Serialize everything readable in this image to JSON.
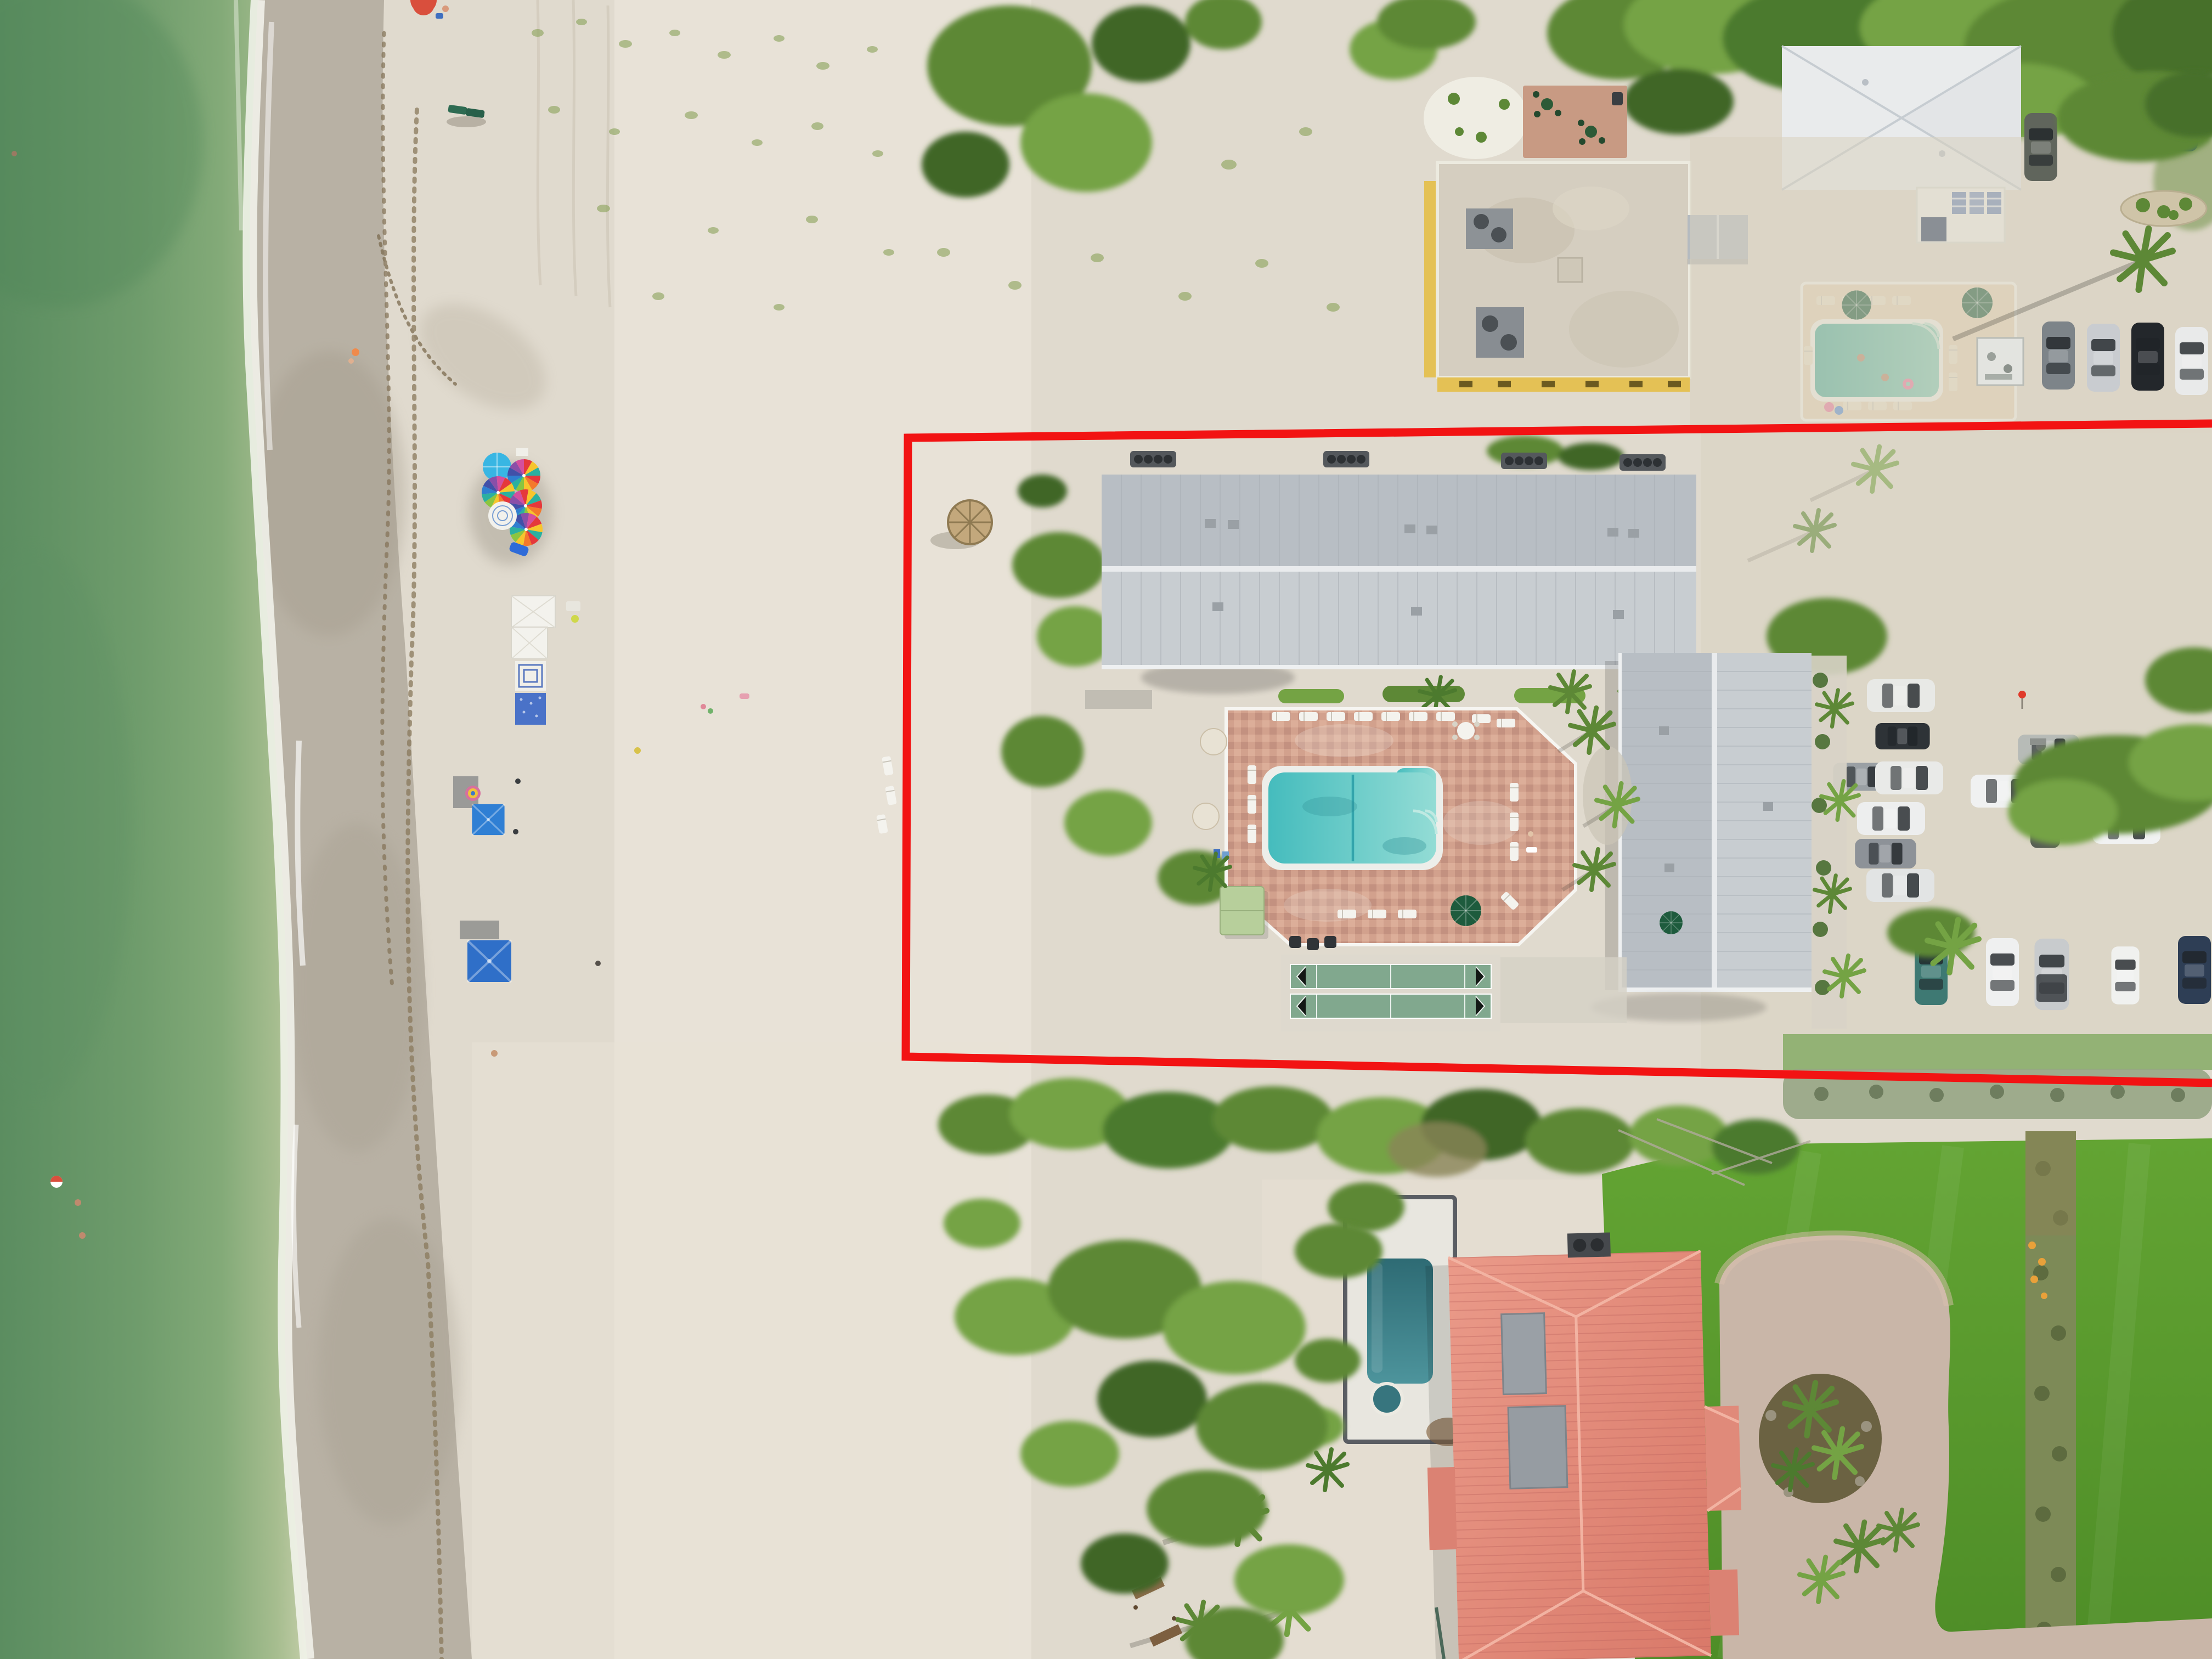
{
  "scene": {
    "title": "Top-down aerial drone photo of a beachfront resort parcel outlined in red",
    "type": "aerial-photograph",
    "view": "nadir (straight down)",
    "setting": "white-sand gulf beach, dune vegetation, condo buildings, pools, shell parking lot, neighboring estate with coral tile roof"
  },
  "palette": {
    "ocean_deep": "#5b8d60",
    "ocean": "#6f9c6c",
    "ocean_mid": "#83aa78",
    "ocean_shallow": "#a6bd8f",
    "ocean_pale": "#c3cda8",
    "foam": "#f4f6ee",
    "wet_sand": "#b8b1a4",
    "wet_sand_dark": "#a09888",
    "damp_sand": "#cfc8ba",
    "sand": "#e0dace",
    "sand_bright": "#eee9df",
    "wrack_brown": "#86755a",
    "veg_dark": "#3f6628",
    "veg": "#5d8836",
    "veg_bright": "#74a344",
    "veg_olive": "#7e8a4e",
    "veg_gray": "#97a585",
    "veg_brown": "#8a8456",
    "grass_light": "#63a433",
    "grass_dark": "#4e8d27",
    "roof_metal": "#c8cdd1",
    "roof_metal_dark": "#b8bec4",
    "roof_ridge": "#e9ebed",
    "roof_seam": "#a9afb5",
    "roof_white": "#e9ebec",
    "roof_tan": "#d5cec0",
    "wall_yellow": "#e4c155",
    "roof_pink_light": "#ea9a89",
    "roof_pink_dark": "#d97969",
    "panel_gray": "#9aa0a6",
    "paver": "#d2a18d",
    "paver_dark": "#c09180",
    "fence_white": "#f6f5f1",
    "pool_teal": "#45bcbd",
    "pool_teal_light": "#93dcd5",
    "pool2_green": "#4fae9c",
    "pool2_light": "#83cab6",
    "pool_dark": "#2e6b74",
    "pool_dark_light": "#4d949c",
    "concrete": "#d8d3c7",
    "shuffle_green": "#81a88e",
    "gravel": "#d8d1c0",
    "cabana_green": "#b7cf9b",
    "umbrella_green": "#1e5b3d",
    "umbrella_blue": "#38b6e3",
    "umbrella_cream": "#e8e2d4",
    "tent_white": "#f3f2ed",
    "canopy_blue": "#2f6fc6",
    "blanket_blue": "#4a72c8",
    "tiki_straw": "#c3a87c",
    "mulch": "#6b6242",
    "boundary_red": "#f21313"
  },
  "boundary": {
    "label": "subject property outline",
    "color": "#f21313",
    "stroke_px": 15,
    "corner_top_left": [
      1655,
      798
    ],
    "corner_bottom_left": [
      1651,
      1926
    ],
    "top_edge_right_end": [
      4032,
      772
    ],
    "bottom_edge_right_end": [
      4032,
      1974
    ]
  },
  "inventory": {
    "ocean": {
      "swimmers": 3,
      "float_ring": 1,
      "surf": "gentle foam line"
    },
    "beach": {
      "rainbow_umbrellas": 4,
      "blue_umbrella": 1,
      "white_umbrella": 1,
      "white_tents": 2,
      "blue_canopies": 2,
      "green_loungers": 2,
      "people_on_sand": 7
    },
    "subject_property": {
      "metal_roof_buildings": 2,
      "pool": "rectangular with spa corner",
      "pool_deck": "terracotta pavers, white fence",
      "loungers": 19,
      "shuffleboard_courts": 2,
      "palapa_umbrella": 1,
      "grill_stations": 4,
      "green_umbrellas": 2,
      "cream_umbrellas": 2,
      "cabana": 1
    },
    "north_neighbor": {
      "yellow_flat_roof_building": 1,
      "white_hip_roof_house": 1,
      "pool": 1,
      "green_umbrellas": 2,
      "pool_swimmers": 2,
      "cars": 7,
      "storage_shed": 1
    },
    "parking_lot": {
      "surface": "crushed shell",
      "cars": 16,
      "utility_trailer": 1
    },
    "south_neighbor": {
      "roof": "coral barrel tile",
      "lap_pool": 1,
      "spa": 1,
      "lawn": "large manicured",
      "circular_driveway": true,
      "palm_island": 1,
      "privacy_hedge": true,
      "wood_walkway_planks": 2
    }
  }
}
